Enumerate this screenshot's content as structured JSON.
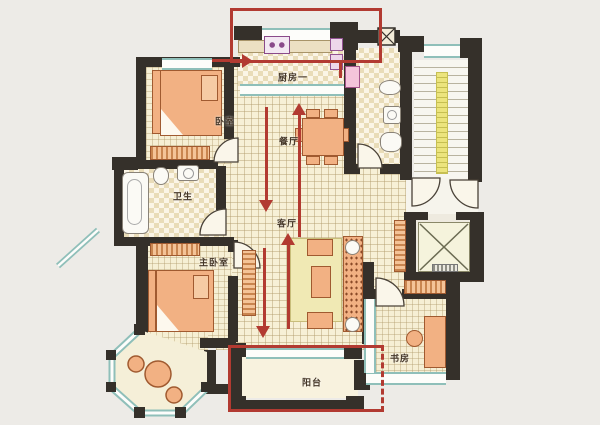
{
  "meta": {
    "title": "apartment floor plan",
    "type": "architectural-floor-plan"
  },
  "palette": {
    "background": "#edebe7",
    "wall": "#35302a",
    "window": "#8fbfb9",
    "floor": "#f7f0d6",
    "furniture": "#f2b183",
    "furniture_border": "#a05a30",
    "rug": "#f0e9b4",
    "stair_rail": "#ece47d",
    "highlight": "#b23a31"
  },
  "rooms": [
    {
      "id": "kitchen",
      "label": "厨房一"
    },
    {
      "id": "bedroom",
      "label": "卧室"
    },
    {
      "id": "dining",
      "label": "餐厅"
    },
    {
      "id": "bathroom",
      "label": "卫生"
    },
    {
      "id": "living",
      "label": "客厅"
    },
    {
      "id": "master-bedroom",
      "label": "主卧室"
    },
    {
      "id": "study",
      "label": "书房"
    },
    {
      "id": "balcony",
      "label": "阳台"
    }
  ],
  "annotations": {
    "highlight_color": "#b23a31",
    "rects": [
      {
        "target": "kitchen",
        "edge_style": "solid"
      },
      {
        "target": "balcony",
        "edge_style": "right-edge-dashed"
      }
    ],
    "arrows": [
      {
        "direction": "right",
        "location": "kitchen-entry"
      },
      {
        "direction": "down",
        "location": "dining-to-living"
      },
      {
        "direction": "up",
        "location": "dining-to-kitchen"
      },
      {
        "direction": "up",
        "location": "living-to-dining"
      },
      {
        "direction": "down",
        "location": "living-to-balcony"
      }
    ]
  },
  "features": [
    "elevator",
    "staircase",
    "bay-window-octagon",
    "balcony-slider"
  ]
}
